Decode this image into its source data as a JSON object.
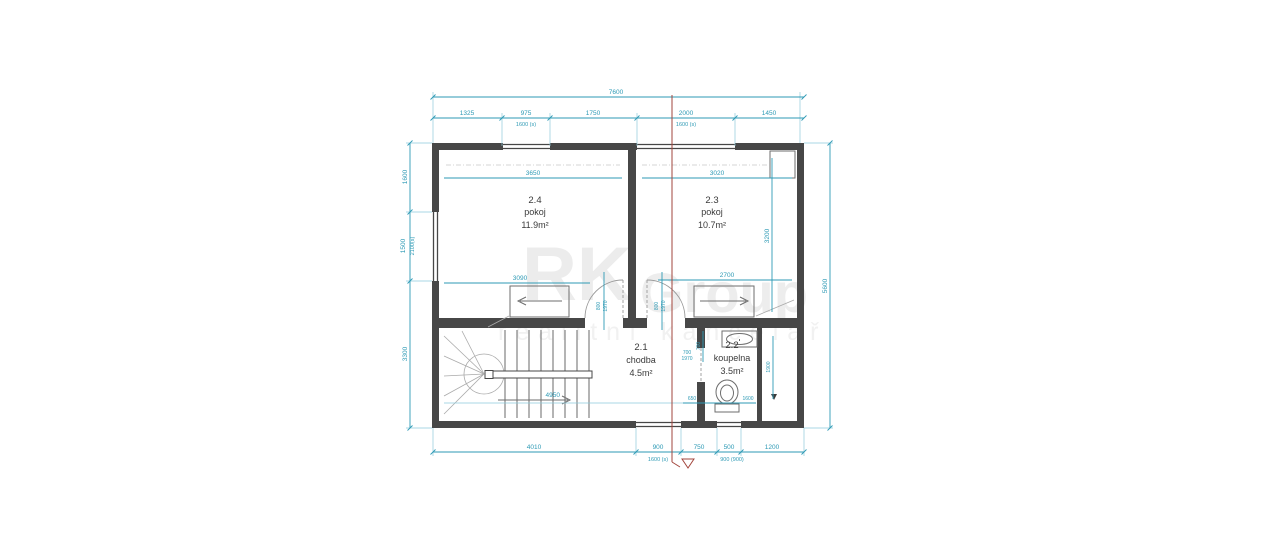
{
  "watermark": {
    "rk": "RK",
    "group": "Group",
    "tagline": "realitní kancelář"
  },
  "rooms": {
    "r24": {
      "number": "2.4",
      "name": "pokoj",
      "area": "11.9m²"
    },
    "r23": {
      "number": "2.3",
      "name": "pokoj",
      "area": "10.7m²"
    },
    "r21": {
      "number": "2.1",
      "name": "chodba",
      "area": "4.5m²"
    },
    "r22": {
      "number": "2.2",
      "name": "koupelna",
      "area": "3.5m²"
    }
  },
  "dims": {
    "total_width": "7600",
    "right_height": "5600",
    "top": {
      "d1": "1325",
      "d2": "975",
      "d2s": "1600 (s)",
      "d3": "1750",
      "d4": "2000",
      "d4s": "1600 (s)",
      "d5": "1450"
    },
    "bottom": {
      "d1": "4010",
      "d2": "900",
      "d2s": "1600 (s)",
      "d3": "750",
      "d4": "500",
      "d4s": "900 (900)",
      "d5": "1200"
    },
    "left": {
      "d1": "1600",
      "d2": "1500",
      "d2s": "2100(s)",
      "d3": "3300"
    },
    "interior": {
      "r24_top": "3650",
      "r24_bottom": "3090",
      "r23_top": "3020",
      "r23_bottom": "2700",
      "r23_right": "3200",
      "door_w": "800",
      "door_h": "1970",
      "bath_door_w": "700",
      "bath_door_h": "1970",
      "sink_d": "700",
      "closet_d": "1900",
      "wc_left": "650",
      "wc_right": "1600",
      "stair_note": "4950"
    }
  }
}
